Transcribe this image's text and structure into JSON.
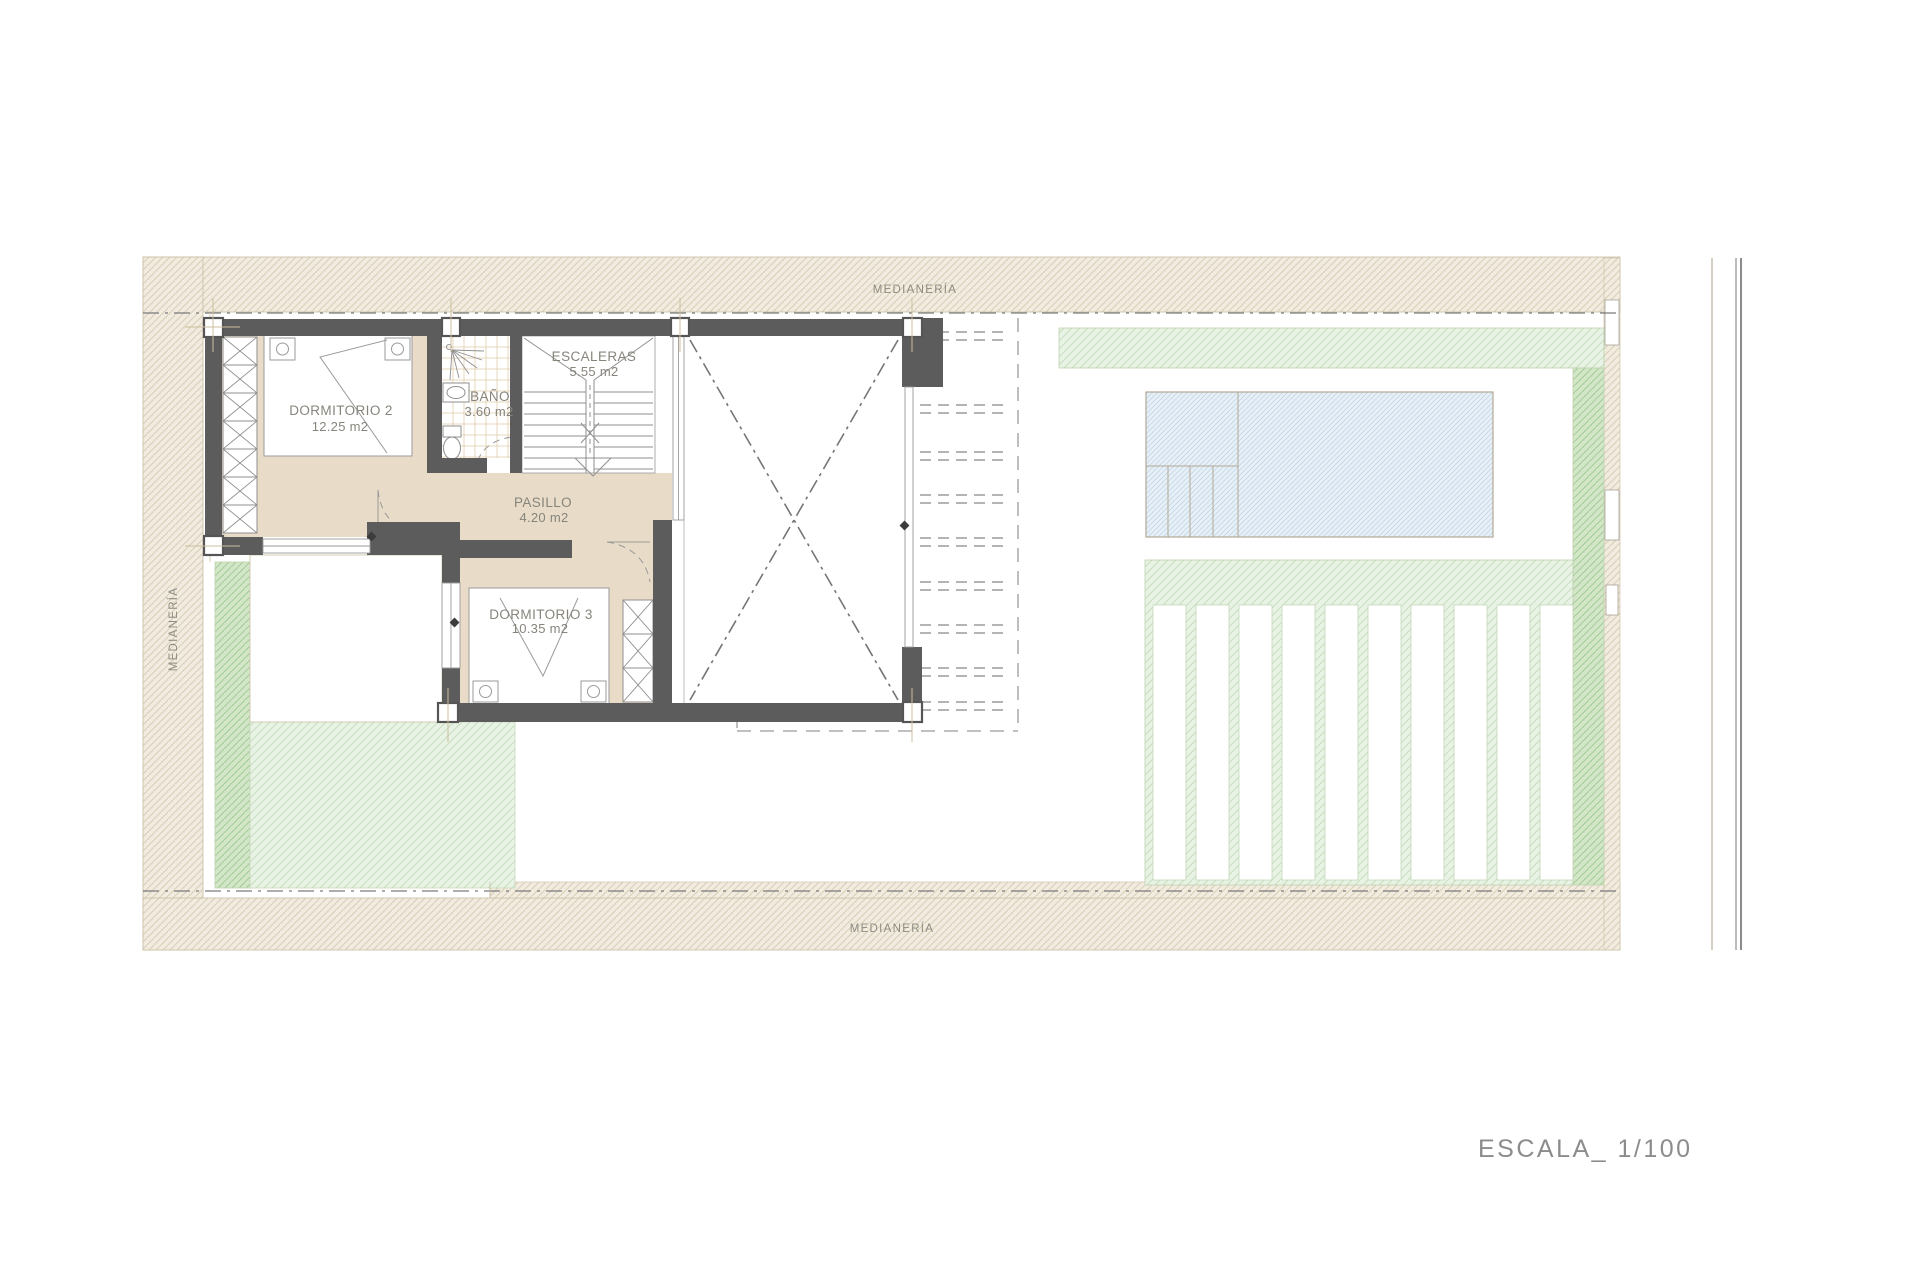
{
  "plan": {
    "boundary_label_top": "MEDIANERÍA",
    "boundary_label_bottom": "MEDIANERÍA",
    "boundary_label_left": "MEDIANERÍA",
    "scale_label": "ESCALA_ 1/100",
    "rooms": [
      {
        "id": "dormitorio-2",
        "name": "DORMITORIO 2",
        "area": "12.25 m2"
      },
      {
        "id": "bano",
        "name": "BAÑO",
        "area": "3.60 m2"
      },
      {
        "id": "escaleras",
        "name": "ESCALERAS",
        "area": "5.55 m2"
      },
      {
        "id": "pasillo",
        "name": "PASILLO",
        "area": "4.20 m2"
      },
      {
        "id": "dormitorio-3",
        "name": "DORMITORIO 3",
        "area": "10.35 m2"
      }
    ],
    "colors": {
      "wall": "#5c5c5c",
      "floor_beige": "#e8dcc8",
      "border_hatch_bg": "#f1ecdf",
      "border_hatch_line": "#d9cdb5",
      "green_light_bg": "#e9f3e5",
      "green_light_line": "#c7dfc0",
      "green_dark_bg": "#d3e7c8",
      "green_dark_line": "#a6cc99",
      "pool_bg": "#e8f0f7",
      "pool_line": "#c2d6e8",
      "label_gray": "#86847b"
    }
  }
}
